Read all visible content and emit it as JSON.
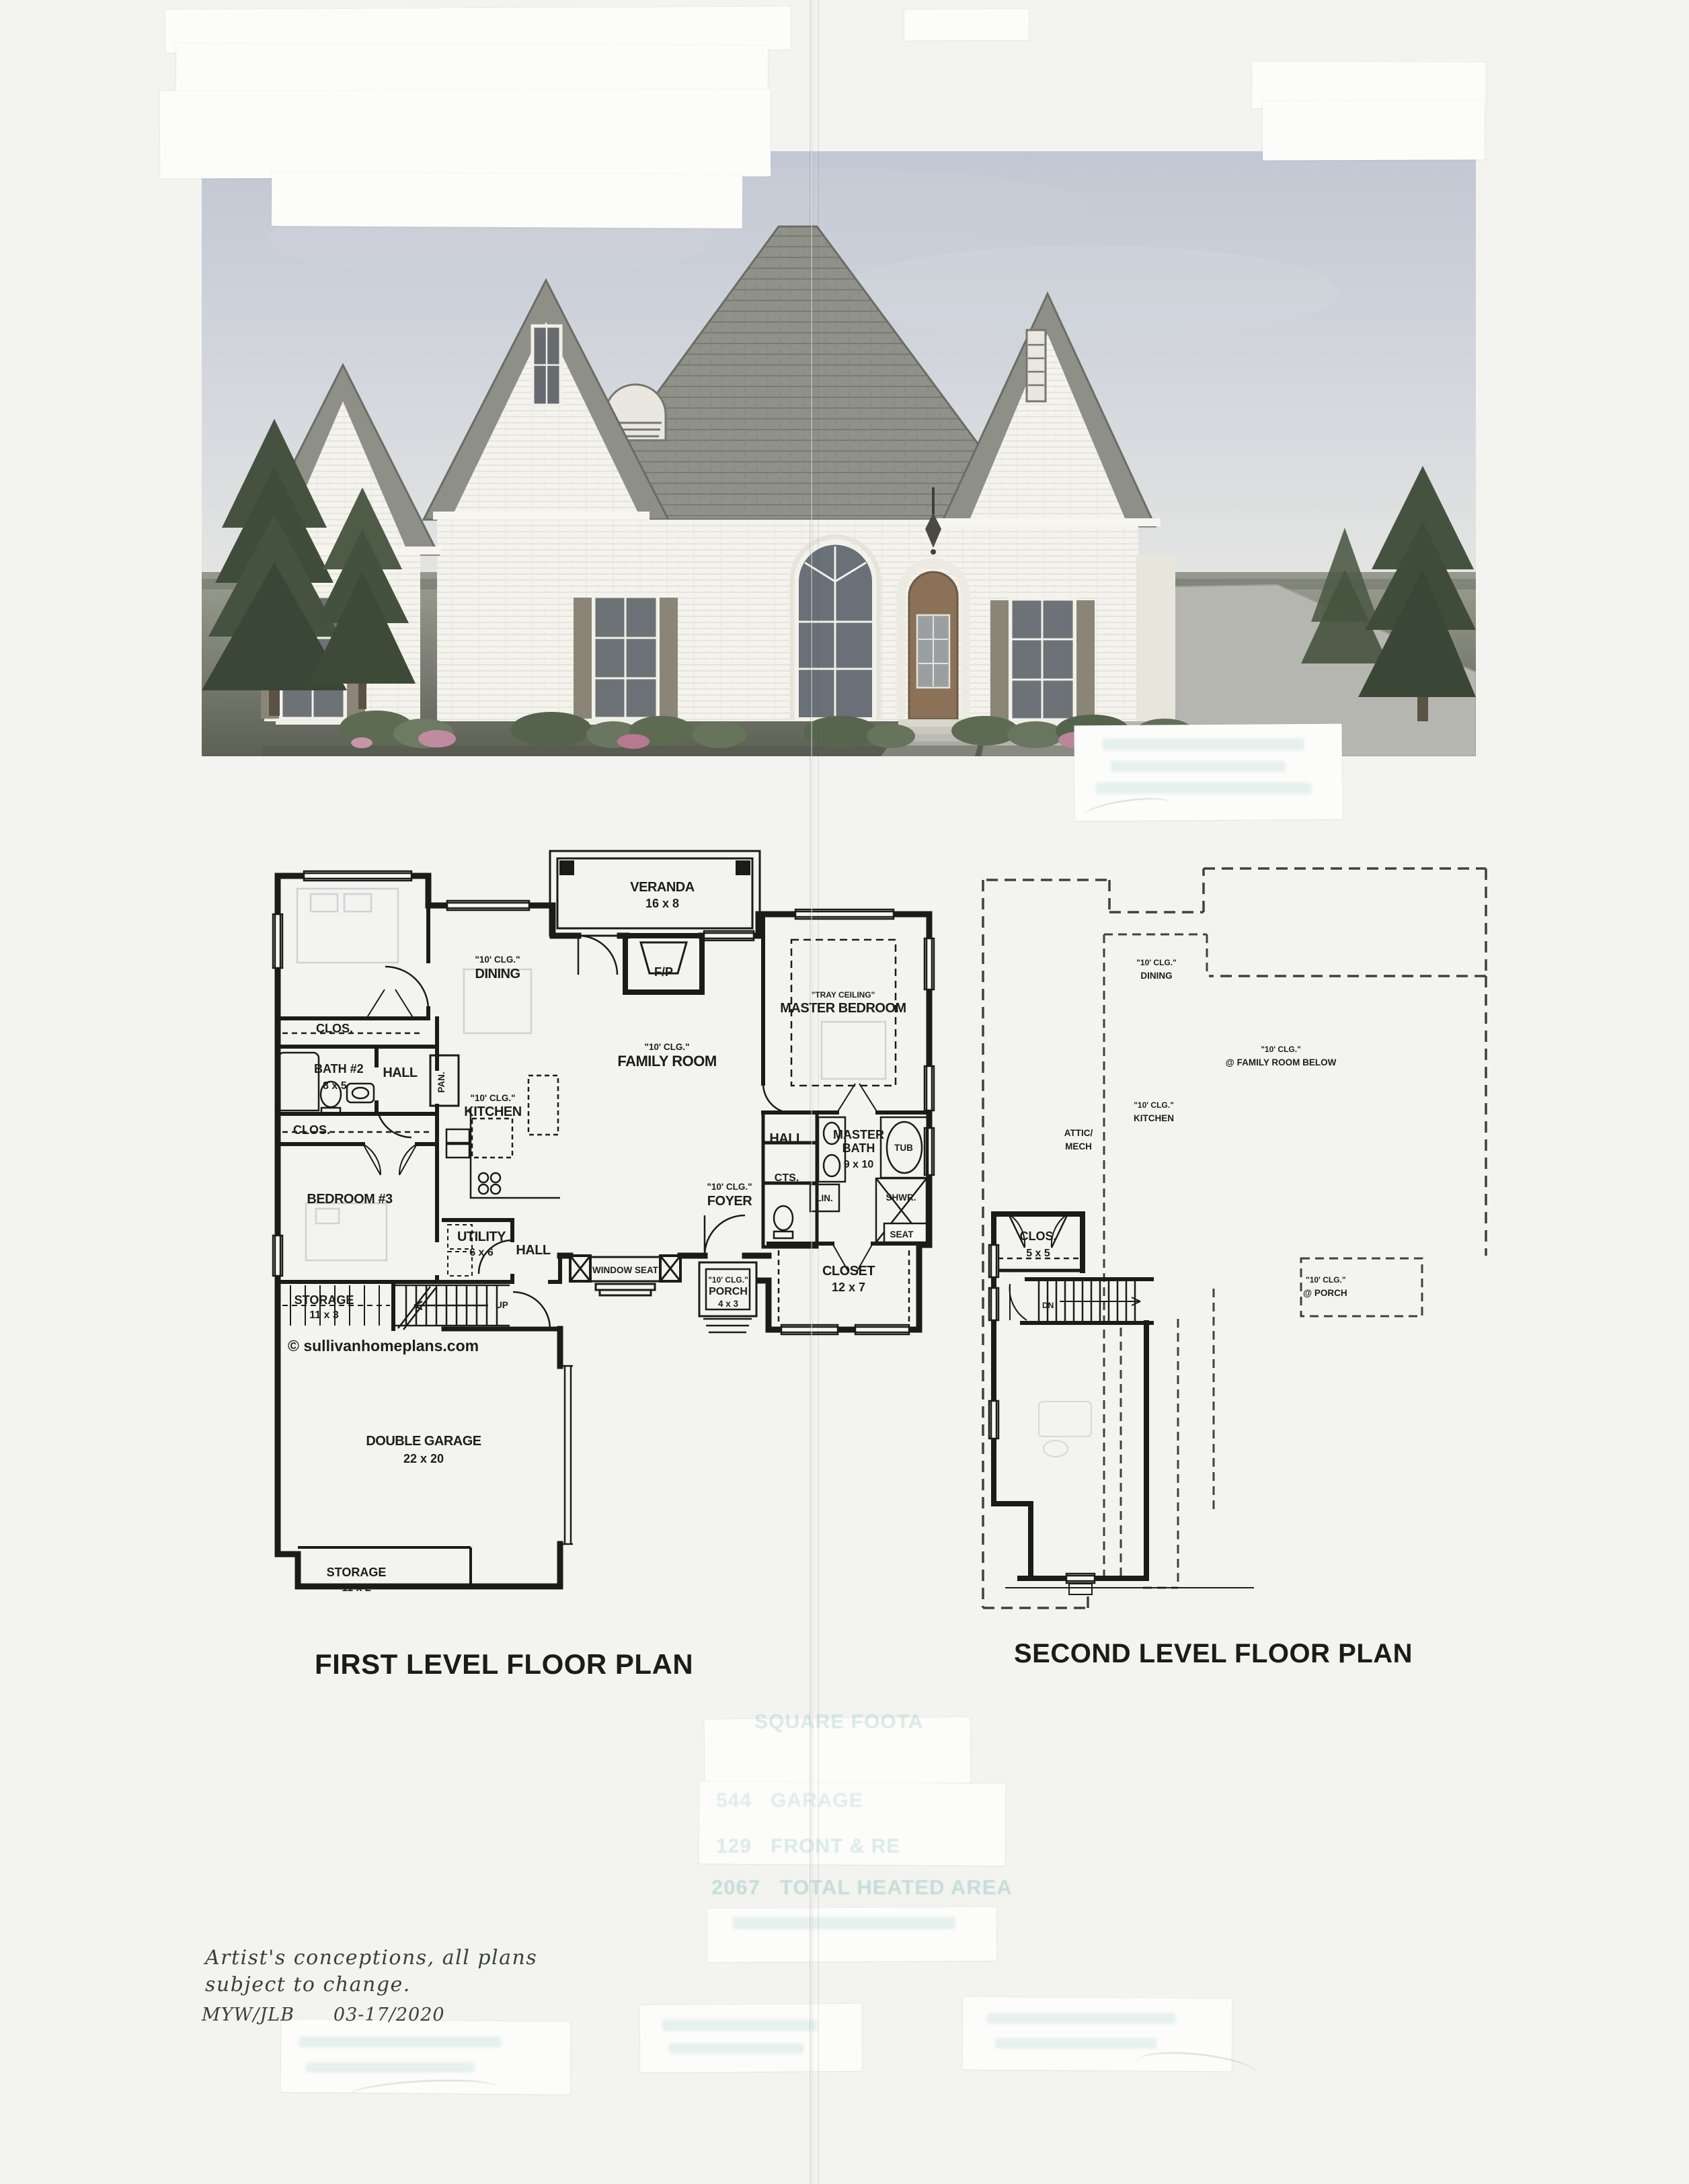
{
  "first_floor": {
    "title": "FIRST LEVEL FLOOR PLAN",
    "watermark": "© sullivanhomeplans.com",
    "labels": {
      "veranda": "VERANDA",
      "veranda_dim": "16 x 8",
      "fp": "F/P",
      "dining_clg": "\"10' CLG.\"",
      "dining": "DINING",
      "family_clg": "\"10' CLG.\"",
      "family": "FAMILY ROOM",
      "master_tray": "\"TRAY CEILING\"",
      "master": "MASTER BEDROOM",
      "clos1": "CLOS.",
      "bath2": "BATH #2",
      "bath2_dim": "8 x 5",
      "hall_top": "HALL",
      "clos2": "CLOS.",
      "bedroom3": "BEDROOM #3",
      "pan": "PAN.",
      "kitchen_clg": "\"10' CLG.\"",
      "kitchen": "KITCHEN",
      "utility": "UTILITY",
      "utility_dim": "6 x 6",
      "hall_mid": "HALL",
      "storage1": "STORAGE",
      "storage1_dim": "11 x 3",
      "up": "UP",
      "garage": "DOUBLE GARAGE",
      "garage_dim": "22 x 20",
      "storage2": "STORAGE",
      "storage2_dim": "11 x 2",
      "window_seat": "WINDOW SEAT",
      "foyer_clg": "\"10' CLG.\"",
      "foyer": "FOYER",
      "porch_clg": "\"10' CLG.\"",
      "porch": "PORCH",
      "porch_dim": "4 x 3",
      "closet": "CLOSET",
      "closet_dim": "12 x 7",
      "hall_master": "HALL",
      "cts": "CTS.",
      "lin": "LIN.",
      "mbath1": "MASTER",
      "mbath2": "BATH",
      "mbath_dim": "9 x 10",
      "tub": "TUB",
      "shwr": "SHWR.",
      "seat": "SEAT"
    }
  },
  "second_floor": {
    "title": "SECOND LEVEL FLOOR PLAN",
    "labels": {
      "clos": "CLOS.",
      "clos_dim": "5 x 5",
      "dn": "DN",
      "dining_clg": "\"10' CLG.\"",
      "dining": "DINING",
      "kitchen_clg": "\"10' CLG.\"",
      "kitchen": "KITCHEN",
      "attic1": "ATTIC/",
      "attic2": "MECH",
      "family_clg": "\"10' CLG.\"",
      "family_below": "@ FAMILY ROOM BELOW",
      "porch_clg": "\"10' CLG.\"",
      "porch_below": "@ PORCH"
    }
  },
  "notes": {
    "line1": "Artist's conceptions, all plans",
    "line2": "subject to change.",
    "credits": "MYW/JLB",
    "date": "03-17/2020"
  },
  "ghost_text": {
    "header": "SQUARE FOOTA",
    "row1_num": "544",
    "row1_label": "GARAGE",
    "row2_num": "129",
    "row2_label": "FRONT & RE",
    "row3_num": "2067",
    "row3_label": "TOTAL HEATED AREA"
  },
  "colors": {
    "plan_ink": "#1d1d1b",
    "ghost_teal": "#8fc2bf",
    "paper": "#f3f3f0",
    "sky": "#c2c7d3",
    "roof": "#8f9189",
    "grass": "#6f7268",
    "shutter": "#8a8577",
    "door": "#8a7158"
  }
}
